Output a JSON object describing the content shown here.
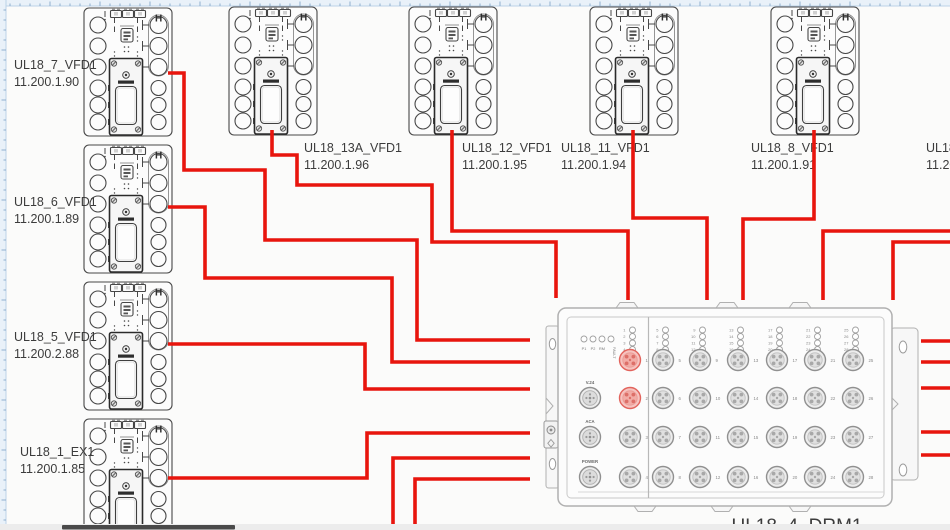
{
  "window": {
    "width": 950,
    "height": 530,
    "background": "#fbfbfa"
  },
  "colors": {
    "wire": "#e8150d",
    "device_stroke": "#474747",
    "drm_stroke": "#b0b0b0",
    "port_gray": "#909090",
    "port_red": "#e2635c",
    "port_red_fill": "#f6c3bf",
    "label_text": "#3c3c3c",
    "tiny_text": "#8a8a8a",
    "ruler_bg": "#e9f1f9",
    "ruler_tick": "#85a9c9",
    "ruler_border": "#bcd2e8",
    "scrollbar_track": "#ececec",
    "scrollbar_thumb": "#4a4a4a"
  },
  "vfd_symbol": {
    "h_mark": "H"
  },
  "devices": [
    {
      "name": "UL18_7_VFD1",
      "ip": "11.200.1.90",
      "x": 83,
      "y": 7,
      "label": {
        "x": 14,
        "y": 69
      }
    },
    {
      "name": "UL18_6_VFD1",
      "ip": "11.200.1.89",
      "x": 83,
      "y": 144,
      "label": {
        "x": 14,
        "y": 206
      }
    },
    {
      "name": "UL18_5_VFD1",
      "ip": "11.200.2.88",
      "x": 83,
      "y": 281,
      "label": {
        "x": 14,
        "y": 341
      }
    },
    {
      "name": "UL18_1_EX1",
      "ip": "11.200.1.85",
      "x": 83,
      "y": 418,
      "label": {
        "x": 20,
        "y": 456
      }
    },
    {
      "name": "UL18_13A_VFD1",
      "ip": "11.200.1.96",
      "x": 228,
      "y": 6,
      "label": {
        "x": 304,
        "y": 152
      }
    },
    {
      "name": "UL18_12_VFD1",
      "ip": "11.200.1.95",
      "x": 408,
      "y": 6,
      "label": {
        "x": 462,
        "y": 152
      }
    },
    {
      "name": "UL18_11_VFD1",
      "ip": "11.200.1.94",
      "x": 589,
      "y": 6,
      "label": {
        "x": 561,
        "y": 152
      }
    },
    {
      "name": "UL18_8_VFD1",
      "ip": "11.200.1.91",
      "x": 770,
      "y": 6,
      "label": {
        "x": 751,
        "y": 152
      }
    }
  ],
  "offscreen_device_label": {
    "name": "UL18",
    "ip": "11.20",
    "x": 926,
    "y1": 152,
    "y2": 169
  },
  "drm": {
    "name": "UL18_4_DRM1",
    "label": {
      "x": 797,
      "y": 532
    },
    "body": {
      "x": 558,
      "y": 308,
      "w": 334,
      "h": 198
    },
    "inner": {
      "x": 567,
      "y": 317,
      "w": 317,
      "h": 181
    },
    "divider_x": 648.5,
    "top_tabs": [
      627,
      727,
      800
    ],
    "bottom_tabs": [
      645,
      722,
      800
    ],
    "status_leds": {
      "labels": [
        "P1",
        "P2",
        "RM",
        "FAULT"
      ],
      "start_x": 584,
      "y": 339,
      "spacing": 9,
      "label_y": 350
    },
    "led_rows_start_y": 330,
    "led_row_spacing": 6.5,
    "port_rows_y": [
      360,
      398,
      437,
      477
    ],
    "port_columns": [
      {
        "x": 630,
        "ports": [
          1,
          2,
          3,
          4
        ]
      },
      {
        "x": 663,
        "ports": [
          5,
          6,
          7,
          8
        ]
      },
      {
        "x": 700,
        "ports": [
          9,
          10,
          11,
          12
        ]
      },
      {
        "x": 738,
        "ports": [
          13,
          14,
          15,
          16
        ]
      },
      {
        "x": 777,
        "ports": [
          17,
          18,
          19,
          20
        ]
      },
      {
        "x": 815,
        "ports": [
          21,
          22,
          23,
          24
        ]
      },
      {
        "x": 853,
        "ports": [
          25,
          26,
          27,
          28
        ]
      }
    ],
    "red_ports": [
      1,
      2
    ],
    "side_connectors": [
      {
        "label": "V.24",
        "x": 590,
        "y": 398
      },
      {
        "label": "ACA",
        "x": 590,
        "y": 437
      },
      {
        "label": "POWER",
        "x": 590,
        "y": 477
      }
    ]
  },
  "connections": [
    {
      "id": "ul18-7-to-drm",
      "points": [
        [
          168,
          73
        ],
        [
          184,
          73
        ],
        [
          184,
          170
        ],
        [
          265,
          170
        ],
        [
          265,
          240
        ],
        [
          417,
          240
        ],
        [
          417,
          340
        ],
        [
          530,
          340
        ]
      ]
    },
    {
      "id": "ul18-6-to-drm",
      "points": [
        [
          168,
          207
        ],
        [
          205,
          207
        ],
        [
          205,
          278
        ],
        [
          392,
          278
        ],
        [
          392,
          362
        ],
        [
          530,
          362
        ]
      ]
    },
    {
      "id": "ul18-5-to-drm",
      "points": [
        [
          168,
          344
        ],
        [
          365,
          344
        ],
        [
          365,
          389
        ],
        [
          530,
          389
        ]
      ]
    },
    {
      "id": "ul18-1-to-drm",
      "points": [
        [
          168,
          478
        ],
        [
          367,
          478
        ],
        [
          367,
          433
        ],
        [
          530,
          433
        ]
      ]
    },
    {
      "id": "ul18-13a-to-drm",
      "points": [
        [
          272,
          130
        ],
        [
          272,
          155
        ],
        [
          297,
          155
        ],
        [
          297,
          185
        ],
        [
          432,
          185
        ],
        [
          432,
          242
        ],
        [
          556,
          242
        ],
        [
          556,
          298
        ]
      ]
    },
    {
      "id": "ul18-12-to-drm",
      "points": [
        [
          452,
          130
        ],
        [
          452,
          231
        ],
        [
          628,
          231
        ],
        [
          628,
          300
        ]
      ]
    },
    {
      "id": "ul18-11-to-drm",
      "points": [
        [
          633,
          130
        ],
        [
          633,
          218
        ],
        [
          707,
          218
        ],
        [
          707,
          300
        ]
      ]
    },
    {
      "id": "ul18-8-to-drm",
      "points": [
        [
          814,
          130
        ],
        [
          814,
          219
        ],
        [
          743,
          219
        ],
        [
          743,
          300
        ]
      ]
    },
    {
      "id": "right-in-1",
      "points": [
        [
          950,
          231
        ],
        [
          823,
          231
        ],
        [
          823,
          300
        ]
      ]
    },
    {
      "id": "right-in-2",
      "points": [
        [
          950,
          242
        ],
        [
          893,
          242
        ],
        [
          893,
          300
        ]
      ]
    },
    {
      "id": "right-stub-1",
      "points": [
        [
          950,
          341
        ],
        [
          921,
          341
        ]
      ]
    },
    {
      "id": "right-stub-2",
      "points": [
        [
          950,
          362
        ],
        [
          921,
          362
        ]
      ]
    },
    {
      "id": "right-stub-3",
      "points": [
        [
          950,
          388
        ],
        [
          921,
          388
        ]
      ]
    },
    {
      "id": "right-stub-4",
      "points": [
        [
          950,
          432
        ],
        [
          921,
          432
        ]
      ]
    },
    {
      "id": "right-stub-5",
      "points": [
        [
          950,
          455
        ],
        [
          921,
          455
        ]
      ]
    },
    {
      "id": "bottom-in-1",
      "points": [
        [
          393,
          532
        ],
        [
          393,
          458
        ],
        [
          530,
          458
        ]
      ]
    },
    {
      "id": "bottom-in-2",
      "points": [
        [
          415,
          532
        ],
        [
          415,
          479
        ],
        [
          530,
          479
        ]
      ]
    }
  ],
  "ruler": {
    "size": 6
  },
  "scrollbar": {
    "track": {
      "x": 0,
      "y": 524,
      "w": 950,
      "h": 6
    },
    "thumb": {
      "x": 62,
      "y": 525,
      "w": 173,
      "h": 4.5
    }
  }
}
